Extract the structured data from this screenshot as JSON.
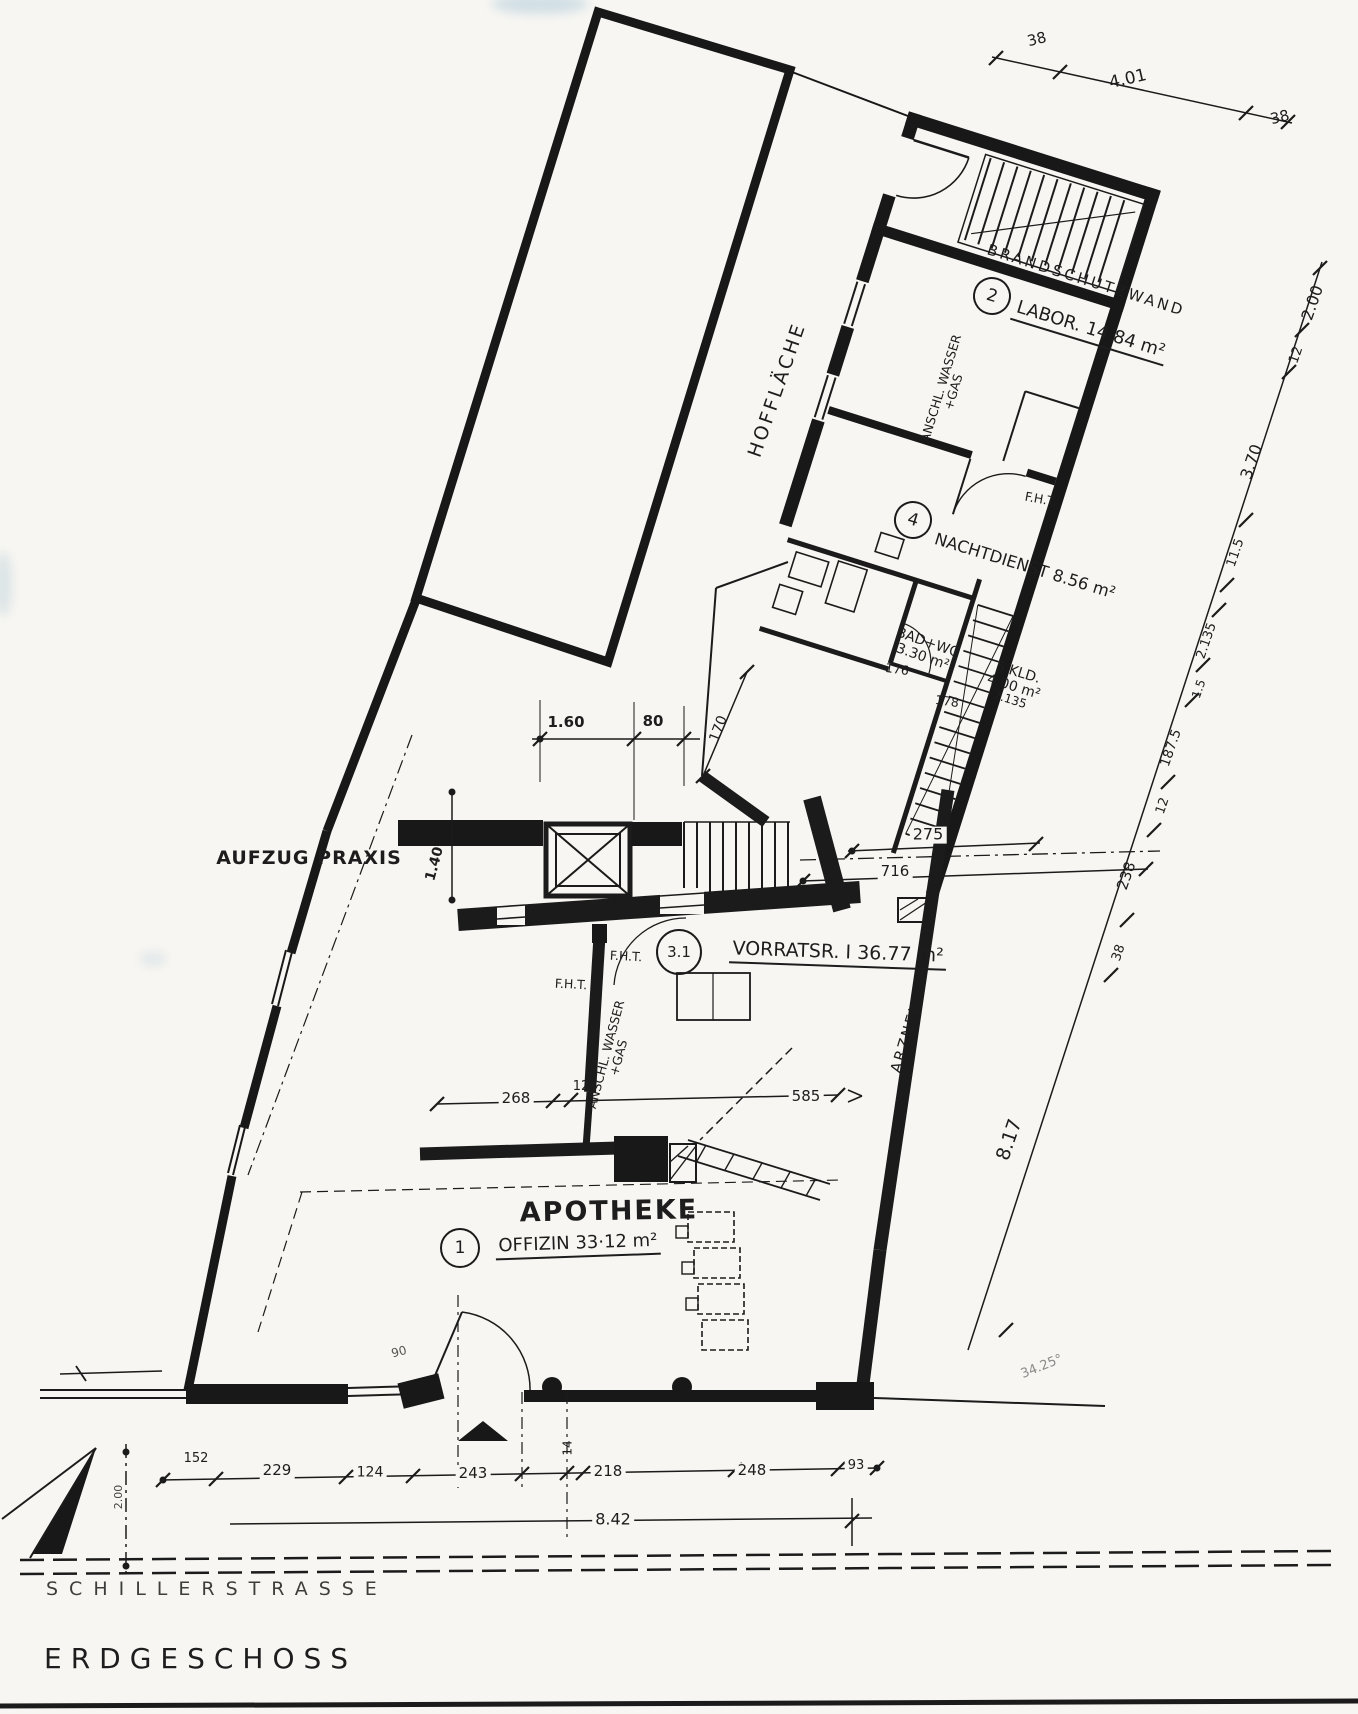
{
  "title": "ERDGESCHOSS",
  "street": "SCHILLERSTRASSE",
  "rooms": {
    "offizin": {
      "num": "1",
      "name": "APOTHEKE",
      "label": "OFFIZIN 33·12 m²"
    },
    "vorrat": {
      "num": "3.1",
      "label": "VORRATSR. I 36.77 m²"
    },
    "labor": {
      "num": "2",
      "label": "LABOR. 14.84 m²"
    },
    "nacht": {
      "num": "4",
      "label": "NACHTDIENST 8.56 m²"
    },
    "bad": {
      "l1": "BAD+WC",
      "l2": "3.30 m²"
    },
    "kld": {
      "l1": "5 KLD.",
      "l2": "4.00 m²",
      "l3": "2.135"
    }
  },
  "notes": {
    "brandschutz": "BRANDSCHUTZWAND",
    "hof": "HOFFLÄCHE",
    "aufzug": "AUFZUG PRAXIS",
    "arznei": "ARZNEI",
    "fht": "F.H.T.",
    "anschl": "ANSCHL. WASSER",
    "gas": "+GAS",
    "door_width": "90",
    "angle": "34.25°"
  },
  "dims": {
    "top": [
      "38",
      "4.01",
      "38"
    ],
    "right": [
      "2.00",
      "12",
      "3.70",
      "11.5",
      "2.135",
      "1.5",
      "187.5",
      "12",
      "238",
      "38",
      "8.17"
    ],
    "mid": {
      "w160": "1.60",
      "w80": "80",
      "w170": "170",
      "w140": "1.40",
      "w275": "275",
      "w716": "716",
      "w268": "268",
      "w12": "12",
      "w585": "585",
      "w176": "176",
      "w178": "178"
    },
    "bottom": [
      "152",
      "229",
      "124",
      "243",
      "14",
      "218",
      "248",
      "93"
    ],
    "total": "8.42",
    "left": "2.00"
  }
}
